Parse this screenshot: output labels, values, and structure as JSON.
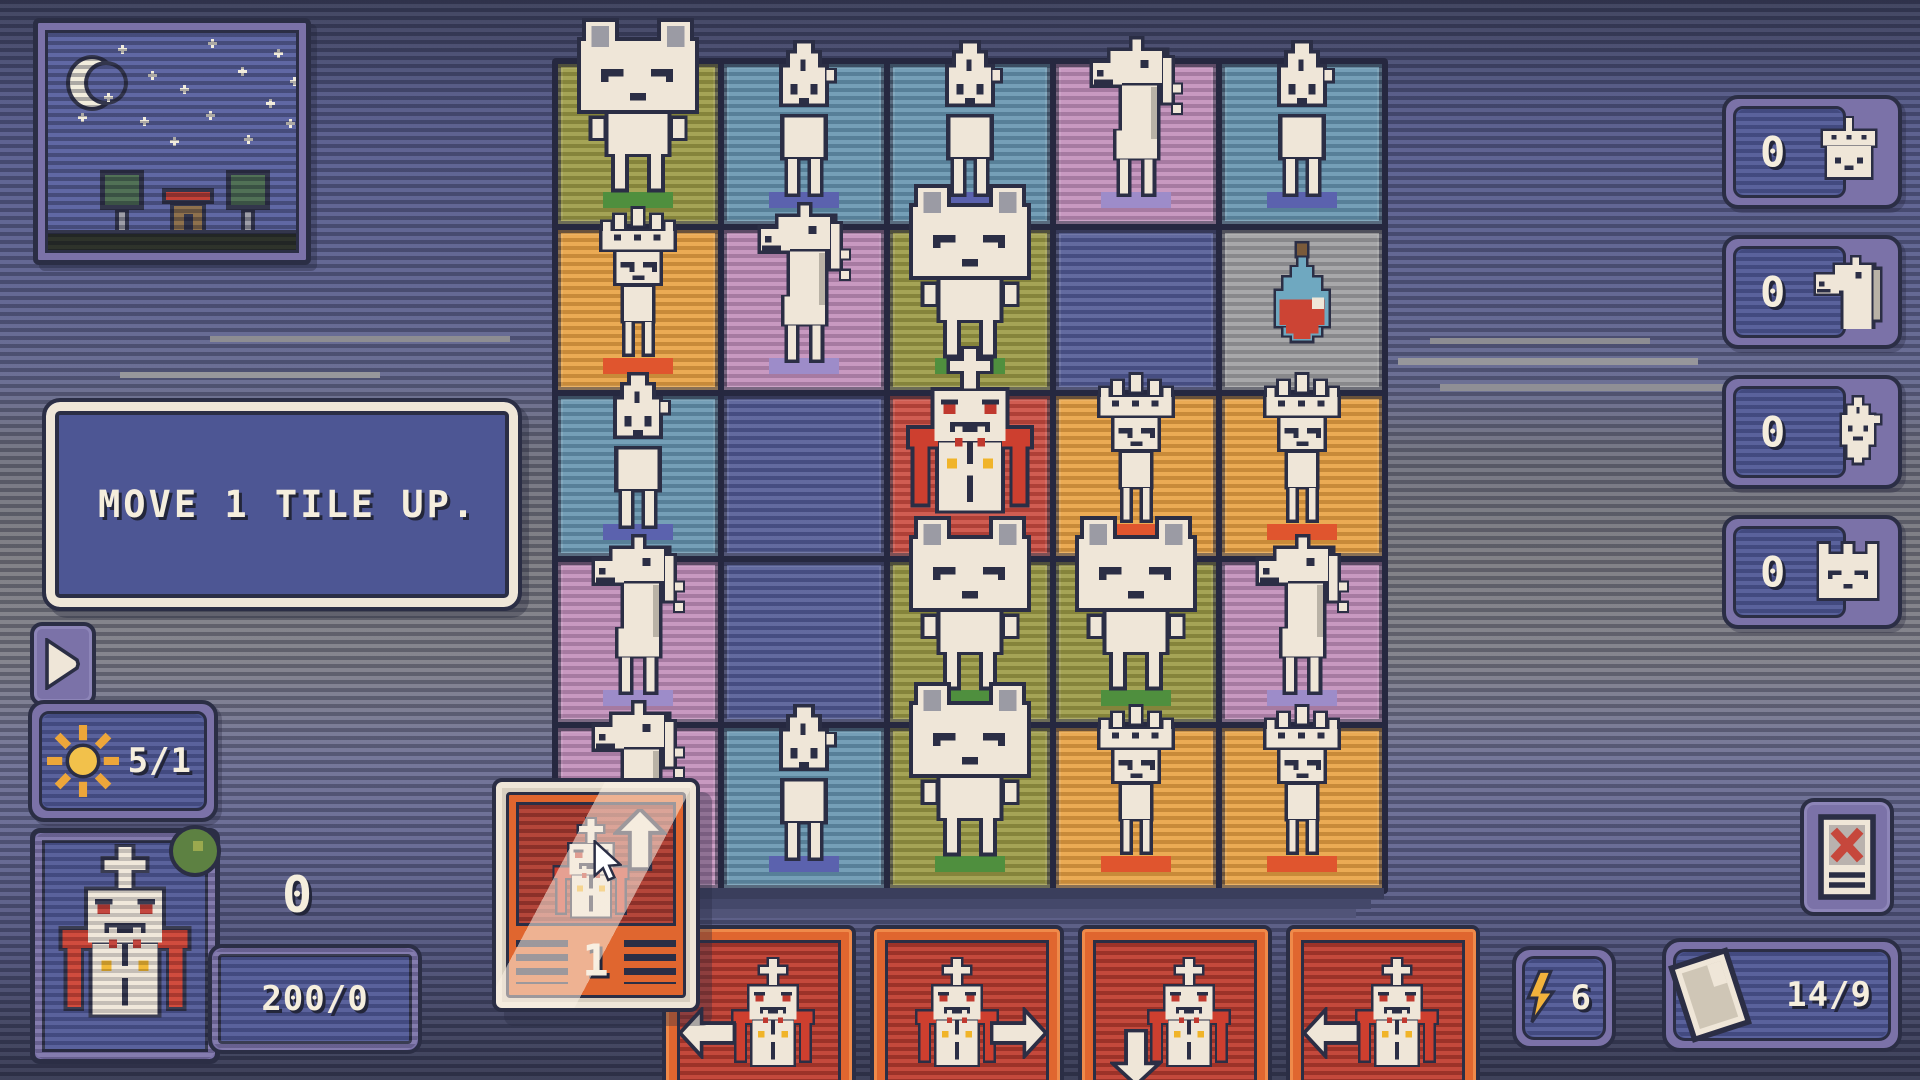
{
  "hud": {
    "message": "MOVE 1 TILE UP.",
    "sun_value": "5/1",
    "gold_value": "0",
    "health_value": "200/0",
    "energy_value": "6",
    "deck_value": "14/9"
  },
  "counters": [
    {
      "id": "queens-captured",
      "icon": "ic-queen",
      "value": "0"
    },
    {
      "id": "knights-captured",
      "icon": "ic-horse",
      "value": "0"
    },
    {
      "id": "pawns-captured",
      "icon": "ic-flame",
      "value": "0"
    },
    {
      "id": "kings-captured",
      "icon": "ic-catking",
      "value": "0"
    }
  ],
  "board": {
    "rows": 5,
    "cols": 5,
    "palette": {
      "olive": "#99973f",
      "teal": "#6292ad",
      "pink": "#c08bb8",
      "darkblue": "#4d5692",
      "orange": "#e89f3c",
      "red": "#c9473a",
      "gray": "#9c9c9e"
    },
    "shadow_palette": {
      "teal": "#5b62ae",
      "pink": "#9d8cc9",
      "olive": "#4f8f3e",
      "orange": "#e0552e"
    },
    "tiles": [
      {
        "color": "olive",
        "piece": "cat"
      },
      {
        "color": "teal",
        "piece": "pawn"
      },
      {
        "color": "teal",
        "piece": "pawn"
      },
      {
        "color": "pink",
        "piece": "knight"
      },
      {
        "color": "teal",
        "piece": "pawn"
      },
      {
        "color": "orange",
        "piece": "crownpawn"
      },
      {
        "color": "pink",
        "piece": "knight"
      },
      {
        "color": "olive",
        "piece": "cat"
      },
      {
        "color": "darkblue",
        "piece": null
      },
      {
        "color": "gray",
        "piece": "potion"
      },
      {
        "color": "teal",
        "piece": "pawn"
      },
      {
        "color": "darkblue",
        "piece": null
      },
      {
        "color": "red",
        "piece": "vampire"
      },
      {
        "color": "orange",
        "piece": "crownpawn"
      },
      {
        "color": "orange",
        "piece": "crownpawn"
      },
      {
        "color": "pink",
        "piece": "knight"
      },
      {
        "color": "darkblue",
        "piece": null
      },
      {
        "color": "olive",
        "piece": "cat"
      },
      {
        "color": "olive",
        "piece": "cat"
      },
      {
        "color": "pink",
        "piece": "knight"
      },
      {
        "color": "pink",
        "piece": "knight"
      },
      {
        "color": "teal",
        "piece": "pawn"
      },
      {
        "color": "olive",
        "piece": "cat"
      },
      {
        "color": "orange",
        "piece": "crownpawn"
      },
      {
        "color": "orange",
        "piece": "crownpawn"
      }
    ]
  },
  "hand": {
    "dragged": {
      "piece": "vampire",
      "direction": "up",
      "count": "1"
    },
    "cards": [
      {
        "piece": "vampire",
        "direction": "left"
      },
      {
        "piece": "vampire",
        "direction": "right"
      },
      {
        "piece": "vampire",
        "direction": "down"
      },
      {
        "piece": "vampire",
        "direction": "left"
      }
    ]
  },
  "scene": {
    "icons": [
      "moon-icon",
      "star-icon",
      "tree-icon",
      "house-icon"
    ],
    "star_count": 15
  }
}
